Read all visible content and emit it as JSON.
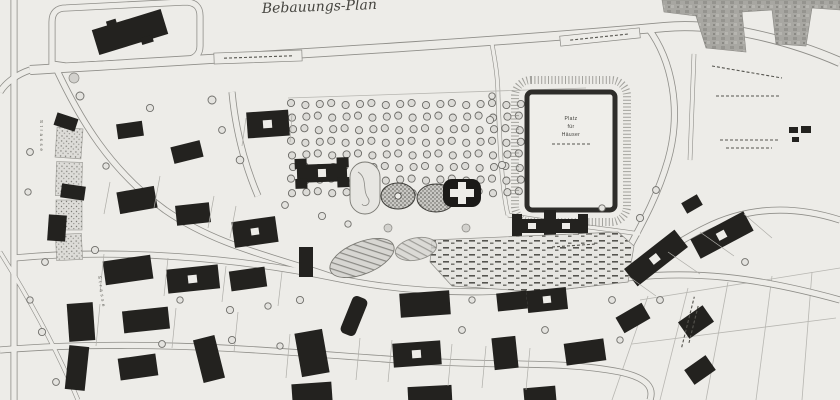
{
  "document": {
    "type": "Scanned historic site plan",
    "title": "Bebauungs-Plan"
  },
  "labels": {
    "plaza_line1": "Platz",
    "plaza_line2": "für",
    "plaza_line3": "Häuser",
    "street_left": "Strasse",
    "street_left_lower": "Strasse"
  },
  "colors": {
    "paper": "#edece8",
    "road_ink": "#8f8e89",
    "building_ink": "#23221f",
    "shading_gray": "#a8a7a2"
  },
  "map": {
    "orchard": {
      "rows": 8,
      "cols": 22
    },
    "features": [
      "orchard-grid",
      "public-square-with-border",
      "church-with-cross-plan",
      "towered-public-building",
      "ponds",
      "oval-garden",
      "allotment-gardens",
      "railway-industrial-area",
      "housing-blocks",
      "field-parcels",
      "street-trees"
    ]
  }
}
